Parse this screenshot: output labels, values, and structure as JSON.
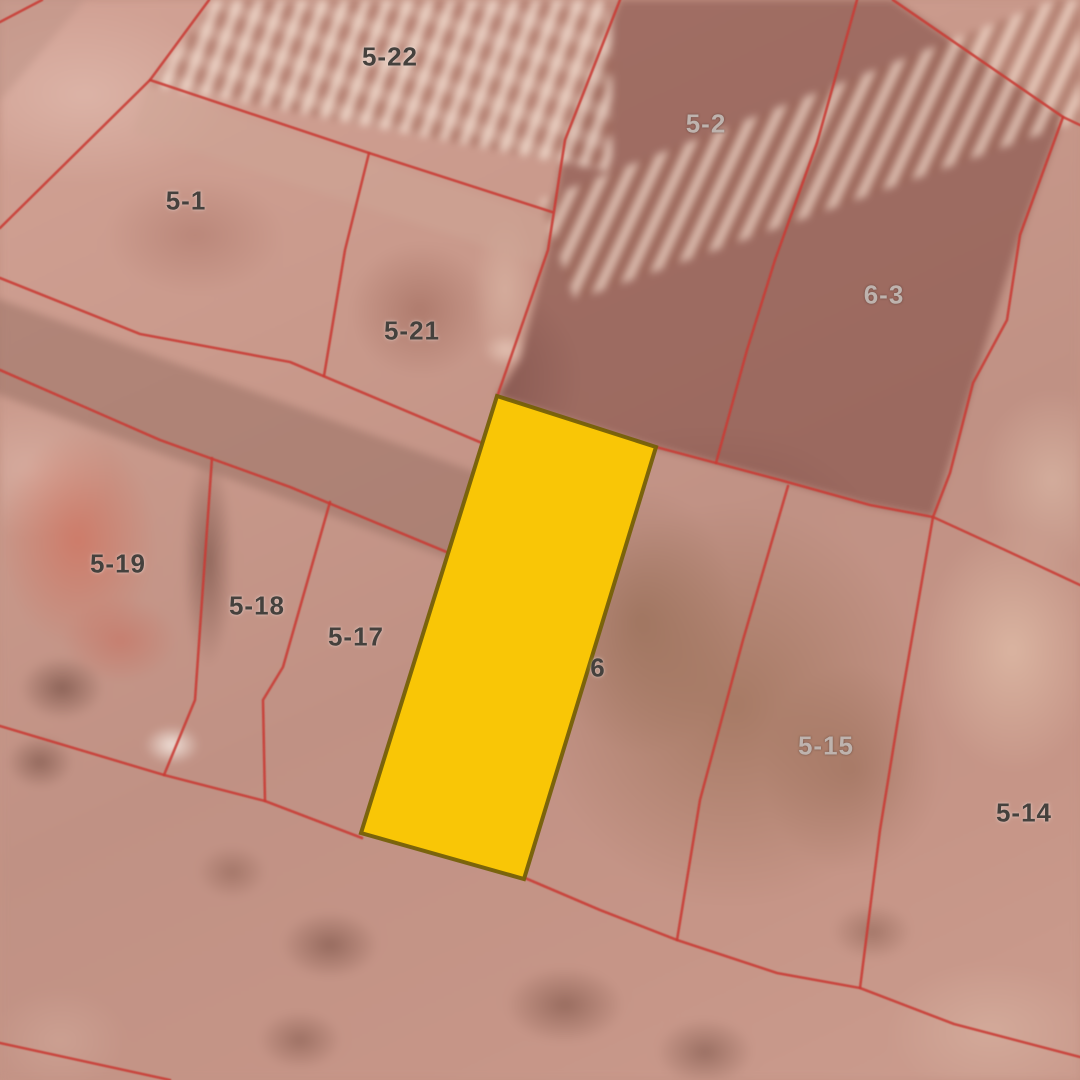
{
  "map": {
    "description": "Cadastral parcel boundary overlay on satellite imagery with one highlighted parcel",
    "boundary_color": "#C83C34",
    "highlight": {
      "fill": "#F9C606",
      "stroke": "#756008",
      "polygon": [
        [
          497,
          396
        ],
        [
          656,
          447
        ],
        [
          524,
          879
        ],
        [
          361,
          833
        ]
      ]
    },
    "parcel_labels": [
      {
        "label": "5-22",
        "x": 390,
        "y": 57,
        "tone": "dark"
      },
      {
        "label": "5-2",
        "x": 706,
        "y": 124,
        "tone": "light"
      },
      {
        "label": "5-1",
        "x": 186,
        "y": 201,
        "tone": "dark"
      },
      {
        "label": "6-3",
        "x": 884,
        "y": 295,
        "tone": "light"
      },
      {
        "label": "5-21",
        "x": 412,
        "y": 331,
        "tone": "dark"
      },
      {
        "label": "5-19",
        "x": 118,
        "y": 564,
        "tone": "dark"
      },
      {
        "label": "5-18",
        "x": 257,
        "y": 606,
        "tone": "dark"
      },
      {
        "label": "5-17",
        "x": 356,
        "y": 637,
        "tone": "dark"
      },
      {
        "label": "6",
        "x": 598,
        "y": 668,
        "tone": "dark"
      },
      {
        "label": "5-15",
        "x": 826,
        "y": 746,
        "tone": "light"
      },
      {
        "label": "5-14",
        "x": 1024,
        "y": 813,
        "tone": "dark"
      }
    ],
    "boundary_lines": [
      {
        "name": "top-left-corner",
        "points": [
          [
            42,
            0
          ],
          [
            0,
            22
          ]
        ]
      },
      {
        "name": "street-upper-west",
        "points": [
          [
            209,
            0
          ],
          [
            150,
            80
          ],
          [
            0,
            228
          ]
        ]
      },
      {
        "name": "block-a-north",
        "points": [
          [
            150,
            80
          ],
          [
            369,
            153
          ],
          [
            552,
            212
          ]
        ]
      },
      {
        "name": "divider-5-1-5-21",
        "points": [
          [
            369,
            153
          ],
          [
            345,
            250
          ],
          [
            324,
            376
          ]
        ]
      },
      {
        "name": "street-mid-upper",
        "points": [
          [
            0,
            278
          ],
          [
            140,
            334
          ],
          [
            290,
            362
          ],
          [
            482,
            443
          ]
        ]
      },
      {
        "name": "street-mid-lower",
        "points": [
          [
            0,
            370
          ],
          [
            160,
            440
          ],
          [
            290,
            487
          ],
          [
            449,
            553
          ]
        ]
      },
      {
        "name": "parcel-5-2-west",
        "points": [
          [
            620,
            0
          ],
          [
            565,
            140
          ],
          [
            548,
            250
          ],
          [
            497,
            397
          ]
        ]
      },
      {
        "name": "divider-5-2-6-3",
        "points": [
          [
            857,
            0
          ],
          [
            817,
            143
          ],
          [
            775,
            260
          ],
          [
            747,
            350
          ],
          [
            716,
            463
          ]
        ]
      },
      {
        "name": "block-b-northeast",
        "points": [
          [
            893,
            0
          ],
          [
            1063,
            117
          ],
          [
            1080,
            125
          ]
        ]
      },
      {
        "name": "parcel-6-3-east",
        "points": [
          [
            1063,
            117
          ],
          [
            1020,
            235
          ],
          [
            1007,
            320
          ],
          [
            973,
            383
          ],
          [
            950,
            473
          ],
          [
            933,
            517
          ]
        ]
      },
      {
        "name": "lower-row-north",
        "points": [
          [
            656,
            447
          ],
          [
            780,
            480
          ],
          [
            870,
            505
          ],
          [
            933,
            517
          ],
          [
            1005,
            550
          ],
          [
            1080,
            585
          ]
        ]
      },
      {
        "name": "divider-5-16-5-15",
        "points": [
          [
            788,
            486
          ],
          [
            743,
            640
          ],
          [
            700,
            800
          ],
          [
            677,
            940
          ]
        ]
      },
      {
        "name": "divider-5-15-5-14",
        "points": [
          [
            933,
            517
          ],
          [
            900,
            707
          ],
          [
            880,
            830
          ],
          [
            860,
            988
          ]
        ]
      },
      {
        "name": "bottom-west",
        "points": [
          [
            0,
            726
          ],
          [
            164,
            775
          ],
          [
            265,
            801
          ],
          [
            362,
            838
          ]
        ]
      },
      {
        "name": "bottom-east",
        "points": [
          [
            525,
            878
          ],
          [
            600,
            910
          ],
          [
            677,
            940
          ],
          [
            777,
            973
          ],
          [
            860,
            988
          ],
          [
            954,
            1024
          ],
          [
            1080,
            1057
          ]
        ]
      },
      {
        "name": "divider-5-19-5-18",
        "points": [
          [
            212,
            458
          ],
          [
            195,
            700
          ],
          [
            164,
            775
          ]
        ]
      },
      {
        "name": "divider-5-18-5-17",
        "points": [
          [
            330,
            502
          ],
          [
            283,
            667
          ],
          [
            263,
            700
          ],
          [
            265,
            801
          ]
        ]
      },
      {
        "name": "bottom-left-corner",
        "points": [
          [
            0,
            1043
          ],
          [
            170,
            1080
          ]
        ]
      }
    ]
  }
}
